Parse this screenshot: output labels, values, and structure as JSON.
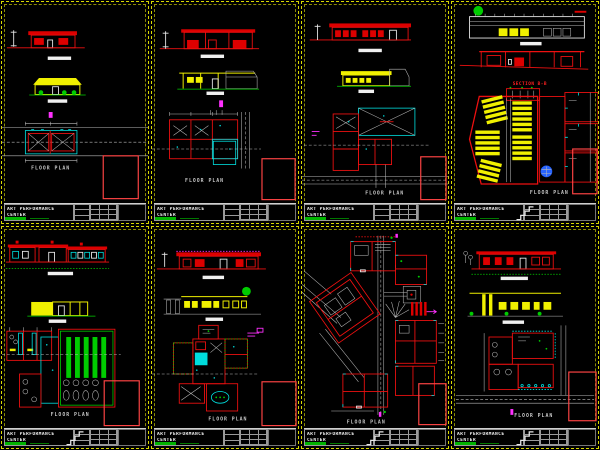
{
  "canvas": {
    "width": 600,
    "height": 450,
    "background": "#000000"
  },
  "palette": {
    "sheet_border": "#d8d800",
    "red": "#ee1010",
    "cyan": "#00e5e5",
    "green": "#00cc00",
    "yellow": "#f0f000",
    "magenta": "#ff30ff",
    "white": "#f0f0f0",
    "gray": "#b9b9b9",
    "blue": "#2864ff",
    "keyplan_border": "#ff4444"
  },
  "titleblock": {
    "line1": "ART PERFORMANCE",
    "line2": "CENTER"
  },
  "panels": [
    {
      "id": 1,
      "caption": "FLOOR PLAN"
    },
    {
      "id": 2,
      "caption": "FLOOR PLAN"
    },
    {
      "id": 3,
      "caption": "FLOOR PLAN"
    },
    {
      "id": 4,
      "caption": "FLOOR PLAN",
      "section_label": "SECTION B-B"
    },
    {
      "id": 5,
      "caption": "FLOOR PLAN"
    },
    {
      "id": 6,
      "caption": "FLOOR PLAN"
    },
    {
      "id": 7,
      "caption": "FLOOR PLAN"
    },
    {
      "id": 8,
      "caption": "FLOOR PLAN"
    }
  ]
}
